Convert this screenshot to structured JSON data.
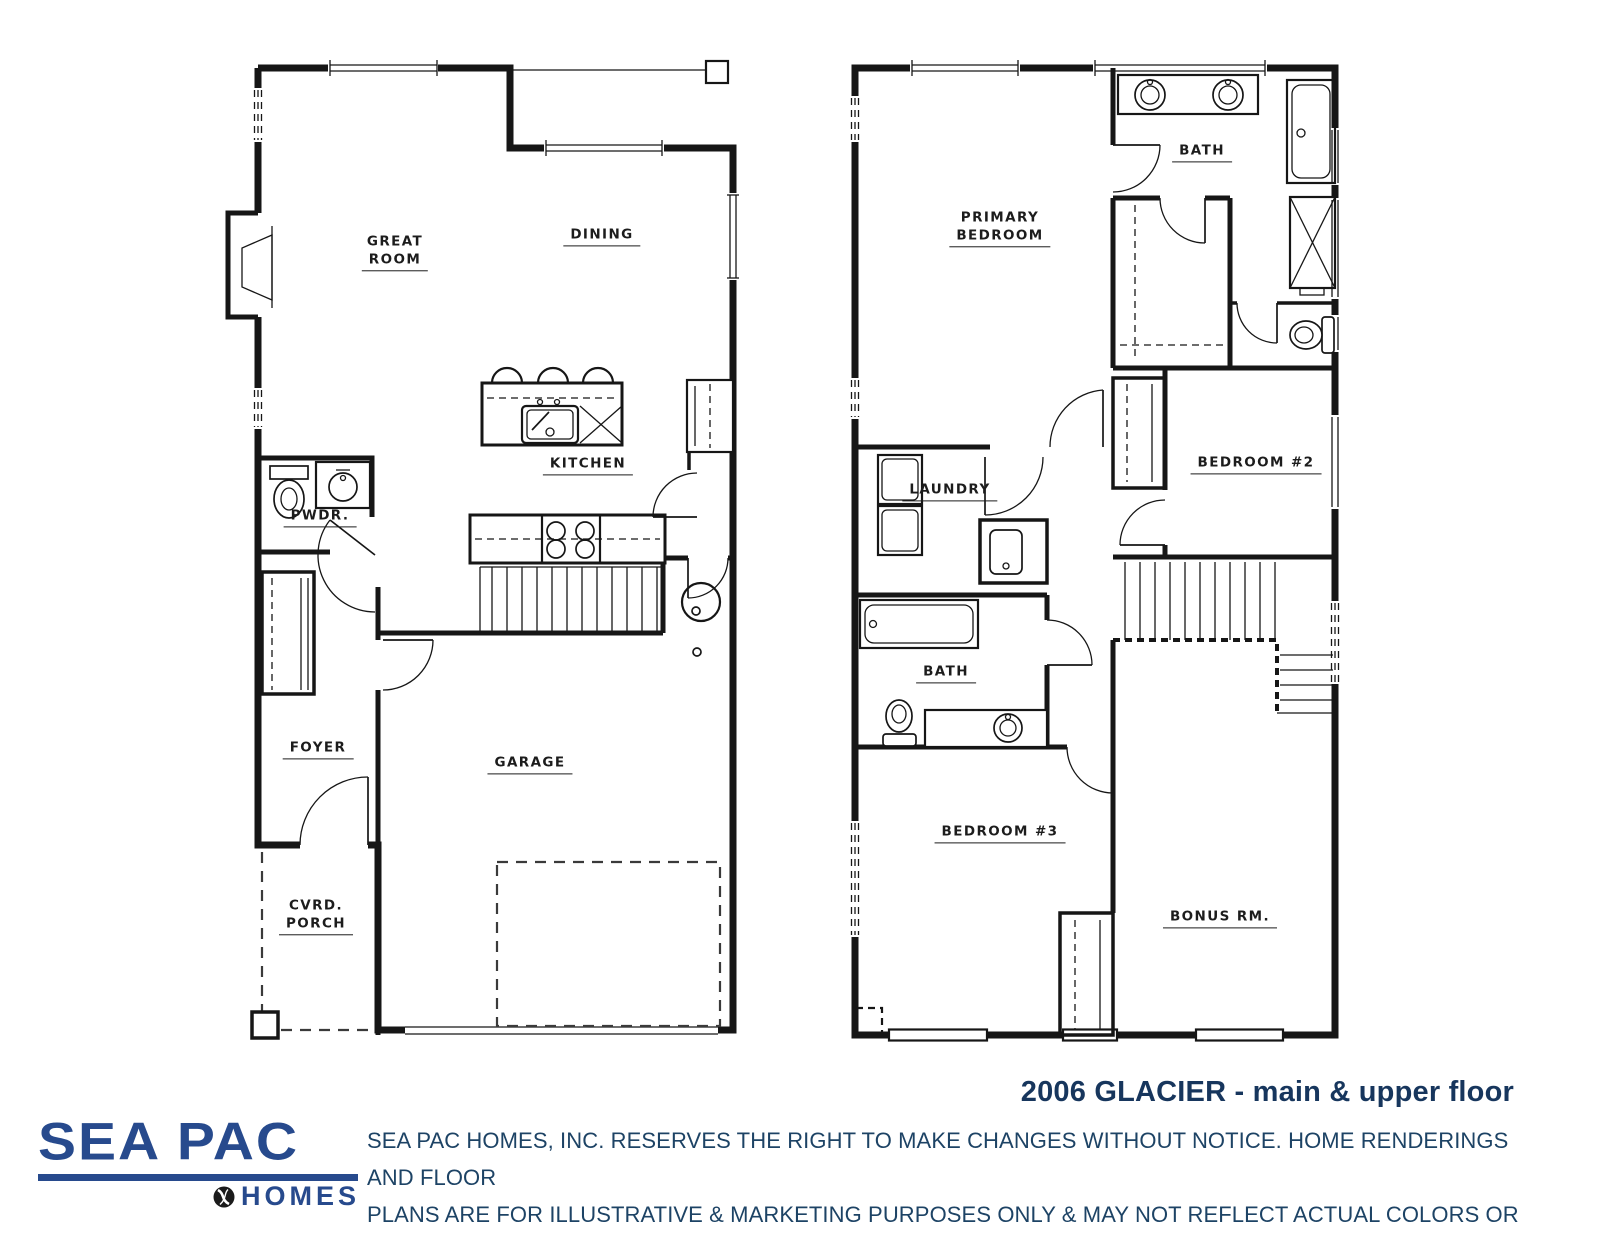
{
  "canvas": {
    "width": 1600,
    "height": 1237,
    "background": "#ffffff"
  },
  "colors": {
    "wall_ink": "#161616",
    "logo_blue": "#274a8d",
    "title_navy": "#17365d",
    "disclaimer_navy": "#1d4365"
  },
  "plans": [
    {
      "id": "main-floor",
      "name": "Main Floor",
      "rooms": [
        {
          "id": "great-room",
          "lines": [
            "GREAT",
            "ROOM"
          ],
          "x": 395,
          "y": 252
        },
        {
          "id": "dining",
          "lines": [
            "DINING"
          ],
          "x": 602,
          "y": 236
        },
        {
          "id": "kitchen",
          "lines": [
            "KITCHEN"
          ],
          "x": 588,
          "y": 465
        },
        {
          "id": "powder",
          "lines": [
            "PWDR."
          ],
          "x": 320,
          "y": 517
        },
        {
          "id": "foyer",
          "lines": [
            "FOYER"
          ],
          "x": 318,
          "y": 749
        },
        {
          "id": "garage",
          "lines": [
            "GARAGE"
          ],
          "x": 530,
          "y": 764
        },
        {
          "id": "covered-porch",
          "lines": [
            "CVRD.",
            "PORCH"
          ],
          "x": 316,
          "y": 916
        }
      ]
    },
    {
      "id": "upper-floor",
      "name": "Upper Floor",
      "rooms": [
        {
          "id": "primary-bedroom",
          "lines": [
            "PRIMARY",
            "BEDROOM"
          ],
          "x": 1000,
          "y": 228
        },
        {
          "id": "primary-bath",
          "lines": [
            "BATH"
          ],
          "x": 1202,
          "y": 152
        },
        {
          "id": "laundry",
          "lines": [
            "LAUNDRY"
          ],
          "x": 950,
          "y": 491
        },
        {
          "id": "bedroom-2",
          "lines": [
            "BEDROOM #2"
          ],
          "x": 1256,
          "y": 464
        },
        {
          "id": "bath-2",
          "lines": [
            "BATH"
          ],
          "x": 946,
          "y": 673
        },
        {
          "id": "bedroom-3",
          "lines": [
            "BEDROOM #3"
          ],
          "x": 1000,
          "y": 833
        },
        {
          "id": "bonus-room",
          "lines": [
            "BONUS RM."
          ],
          "x": 1220,
          "y": 918
        }
      ]
    }
  ],
  "footer": {
    "logo": {
      "primary": "SEA PAC",
      "secondary": "HOMES",
      "icon": "globe"
    },
    "plan_title": "2006 GLACIER - main & upper floor",
    "disclaimer_line1": "SEA PAC HOMES, INC. RESERVES THE RIGHT TO MAKE CHANGES WITHOUT NOTICE.  HOME RENDERINGS AND FLOOR",
    "disclaimer_line2": "PLANS ARE FOR ILLUSTRATIVE & MARKETING PURPOSES ONLY & MAY NOT REFLECT ACTUAL COLORS OR FEATURES."
  }
}
